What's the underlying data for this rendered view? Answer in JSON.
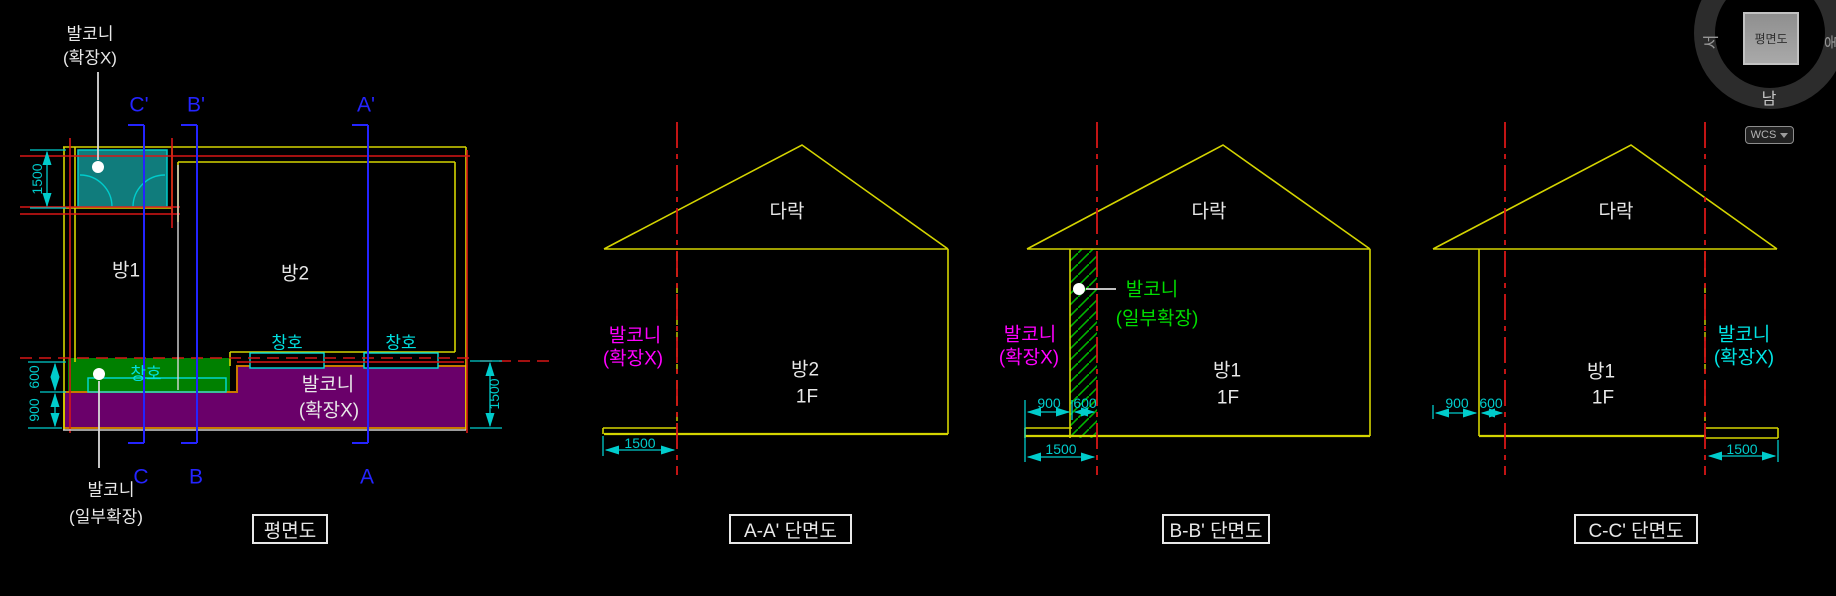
{
  "plan": {
    "title": "평면도",
    "labels": {
      "balcony_top_1": "발코니",
      "balcony_top_2": "(확장X)",
      "balcony_bottom_1": "발코니",
      "balcony_bottom_2": "(일부확장)",
      "balcony_main_1": "발코니",
      "balcony_main_2": "(확장X)",
      "room1": "방1",
      "room2": "방2",
      "window1": "창호",
      "window2": "창호",
      "window3": "창호",
      "mark_c_top": "C'",
      "mark_b_top": "B'",
      "mark_a_top": "A'",
      "mark_c": "C",
      "mark_b": "B",
      "mark_a": "A"
    },
    "dims": {
      "balcony_height": "1500",
      "d600": "600",
      "d900": "900",
      "right_1500": "1500"
    }
  },
  "sections": [
    {
      "title": "A-A' 단면도",
      "attic": "다락",
      "room": "방2",
      "floor": "1F",
      "balcony_1": "발코니",
      "balcony_2": "(확장X)",
      "d1500": "1500"
    },
    {
      "title": "B-B' 단면도",
      "attic": "다락",
      "room": "방1",
      "floor": "1F",
      "balcony_x_1": "발코니",
      "balcony_x_2": "(확장X)",
      "balcony_part_1": "발코니",
      "balcony_part_2": "(일부확장)",
      "d900": "900",
      "d600": "600",
      "d1500": "1500"
    },
    {
      "title": "C-C' 단면도",
      "attic": "다락",
      "room": "방1",
      "floor": "1F",
      "balcony_1": "발코니",
      "balcony_2": "(확장X)",
      "d900": "900",
      "d600": "600",
      "d1500": "1500"
    }
  ],
  "viewcube": {
    "face": "평면도",
    "west": "서",
    "east": "동",
    "south": "남",
    "wcs": "WCS"
  },
  "colors": {
    "background": "#000000",
    "wall_yellow": "#d4d400",
    "grid_red": "#d81616",
    "section_blue": "#2424ff",
    "dimension_cyan": "#00cccc",
    "balcony_teal_fill": "#107c7c",
    "balcony_green_fill": "#008000",
    "balcony_purple_fill": "#6a006a",
    "purple_border_orange": "#c87800",
    "hatch_green": "#00b400",
    "label_magenta": "#ff00ff",
    "label_green": "#00dd00",
    "label_cyan": "#00e5e5",
    "text_white": "#e8e8e8"
  }
}
